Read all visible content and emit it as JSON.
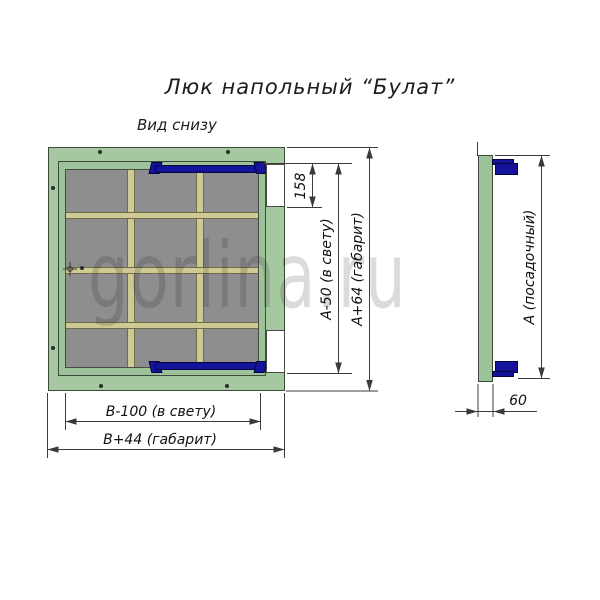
{
  "title": "Люк напольный “Булат”",
  "view_label": "Вид снизу",
  "watermark": "gorlina.ru",
  "dimensions": {
    "latch_offset": "158",
    "clear_height": "А-50 (в свету)",
    "overall_height": "А+64 (габарит)",
    "clear_width": "В-100 (в свету)",
    "overall_width": "В+44 (габарит)",
    "seat_height": "А (посадочный)",
    "profile_depth": "60"
  },
  "parts": {
    "frame": "рама люка",
    "lid": "крышка люка",
    "rib": "ребро жёсткости",
    "hinge": "петля-амортизатор",
    "panel": "лист крышки"
  },
  "colors": {
    "frame_green": "#a6c8a1",
    "lid_green": "#9cc29a",
    "rib_khaki": "#cfca93",
    "panel_gray": "#8e8e8e",
    "hinge_navy": "#14149b",
    "outline_dark": "#3c4b39",
    "dim_line": "#3a3a3a",
    "watermark_gray": "rgba(0,0,0,0.14)"
  }
}
